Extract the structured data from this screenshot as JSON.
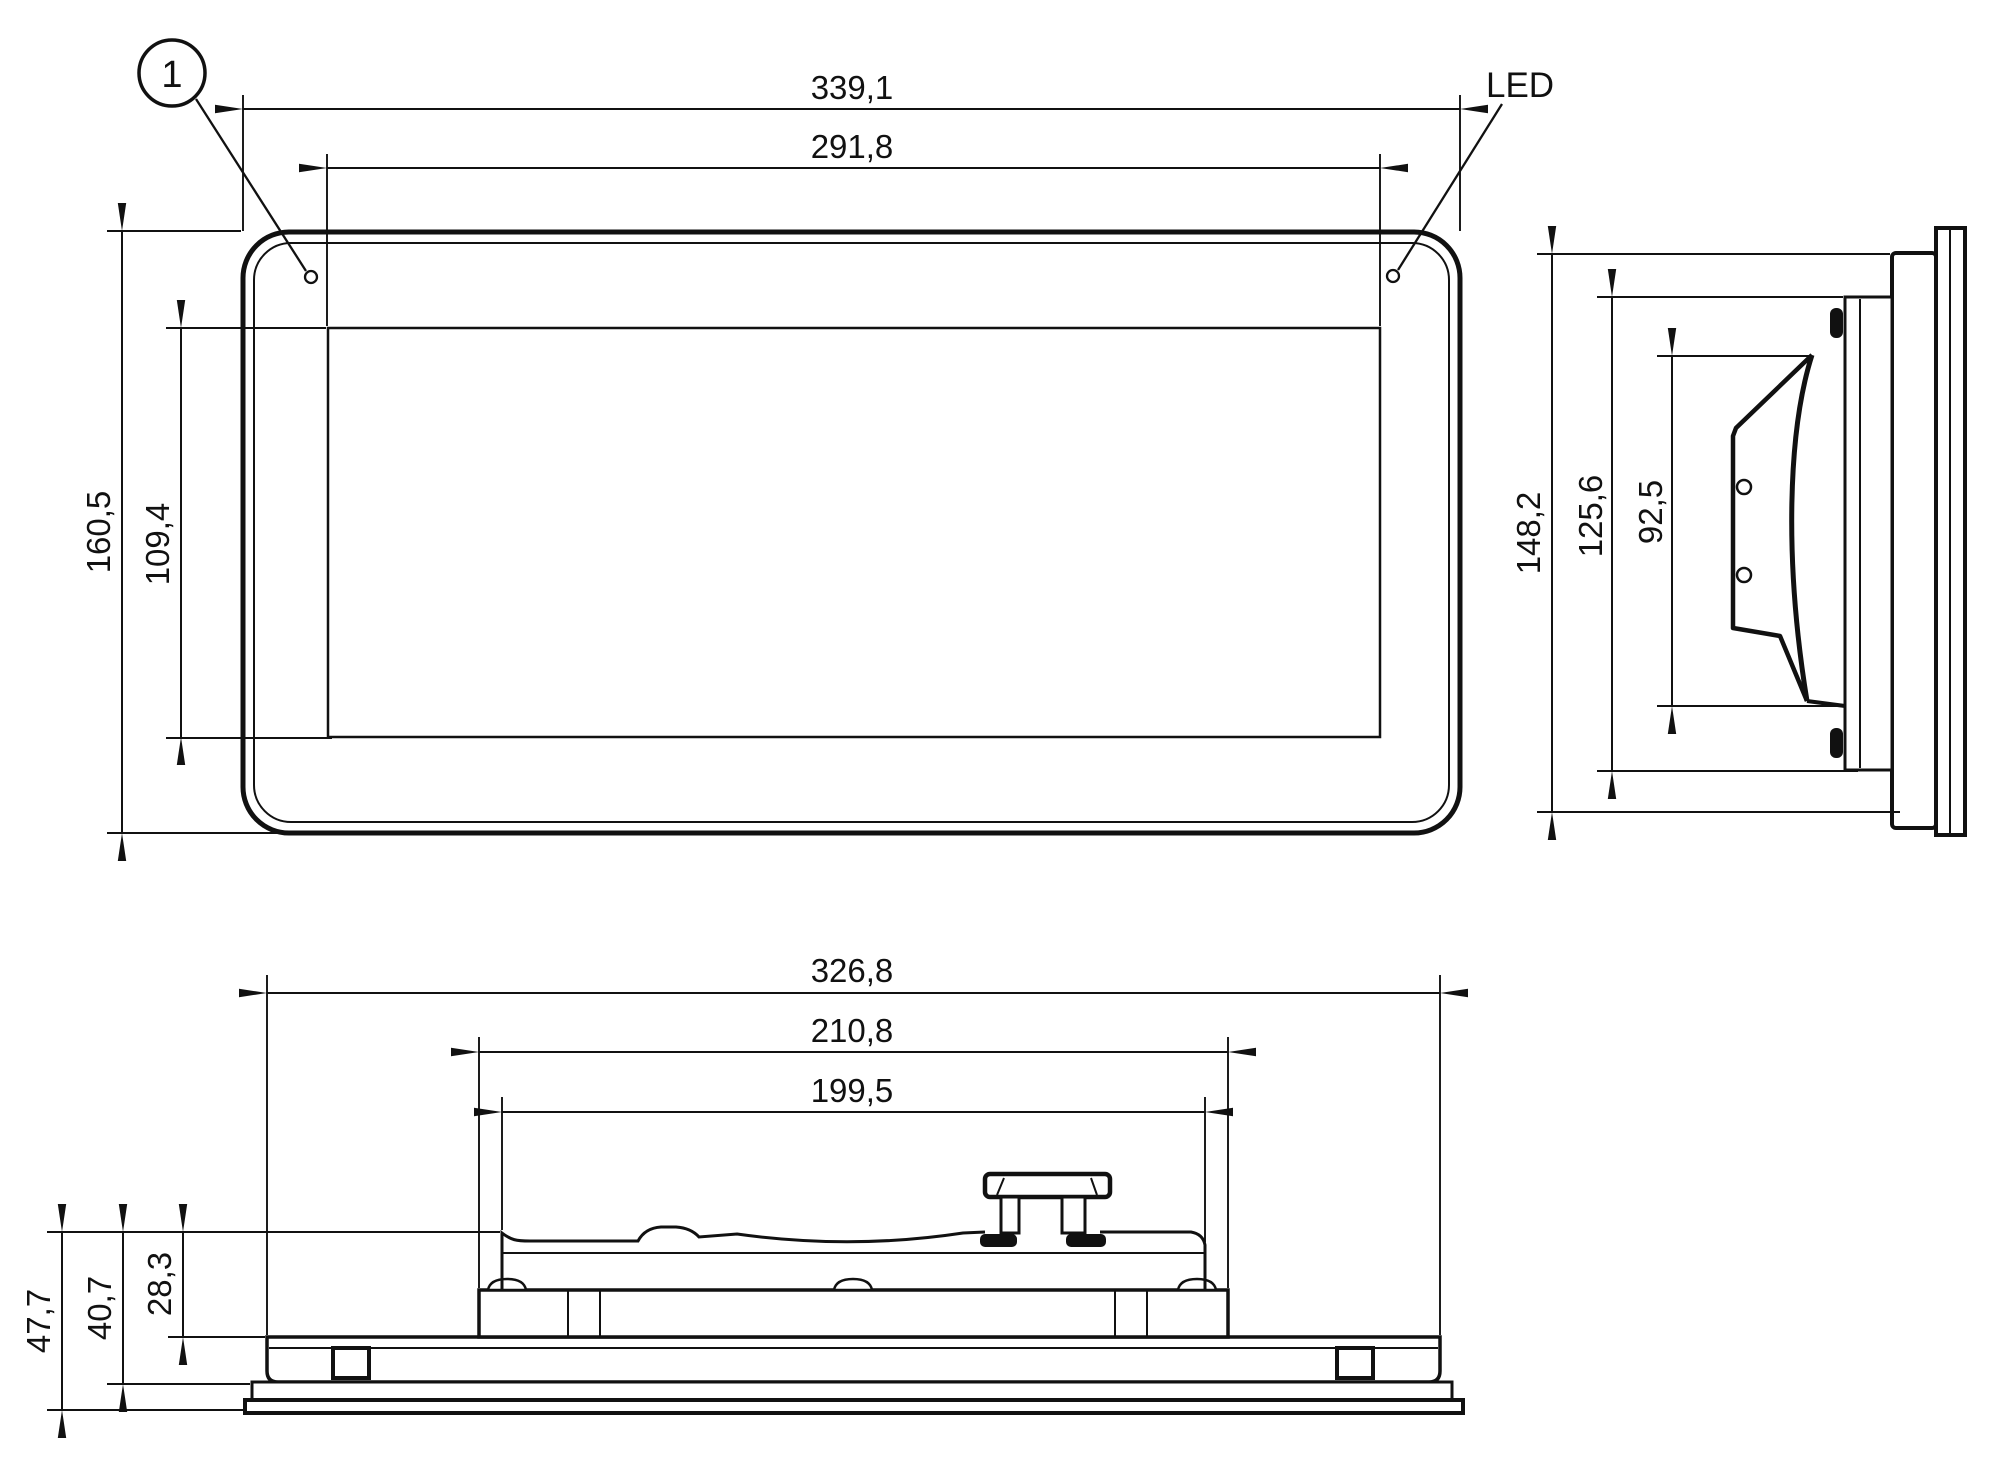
{
  "drawing": {
    "type": "technical-dimension-drawing",
    "background_color": "#ffffff",
    "line_color": "#111111",
    "callouts": {
      "position_marker": "1",
      "led": "LED"
    },
    "front_view": {
      "width_overall_mm": "339,1",
      "width_display_mm": "291,8",
      "height_overall_mm": "160,5",
      "height_display_mm": "109,4"
    },
    "side_view": {
      "height_overall_mm": "148,2",
      "height_housing_mm": "125,6",
      "height_bracket_mm": "92,5"
    },
    "bottom_view": {
      "width_rear_housing_mm": "326,8",
      "width_mount_flange_mm": "210,8",
      "width_mount_body_mm": "199,5",
      "depth_overall_mm": "47,7",
      "depth_to_glass_mm": "40,7",
      "depth_body_mm": "28,3"
    }
  }
}
